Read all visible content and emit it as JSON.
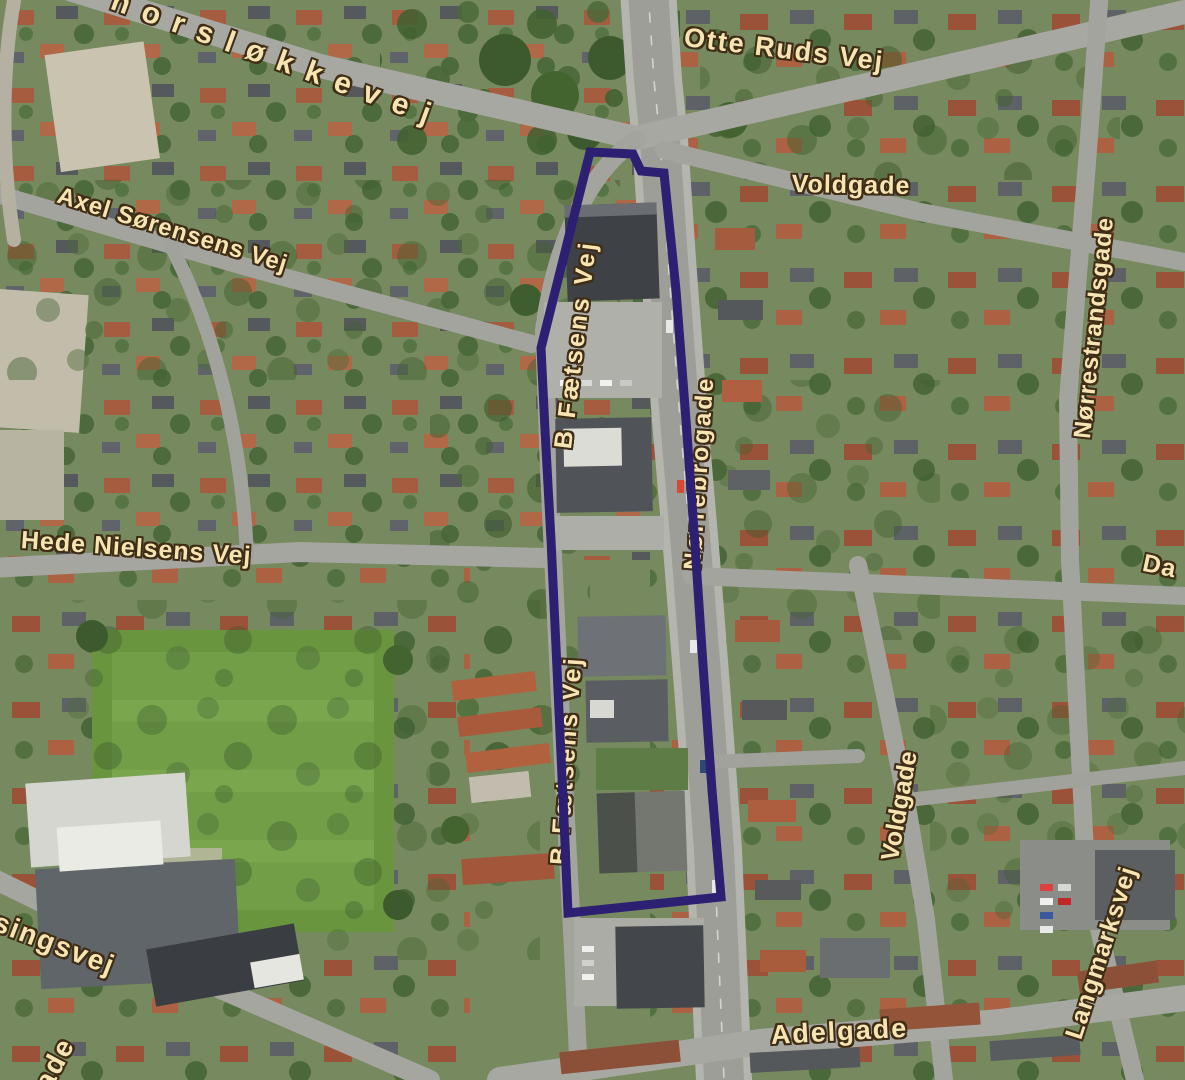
{
  "map": {
    "type": "aerial-orthophoto",
    "description": "Aerial photo map of a Danish town district with a highlighted selection polygon along Nørrebrogade",
    "street_labels": [
      {
        "name": "horslokkevej",
        "text": "horsløkkevej"
      },
      {
        "name": "otte-ruds-vej",
        "text": "Otte Ruds Vej"
      },
      {
        "name": "axel-sorensens-vej",
        "text": "Axel Sørensens Vej"
      },
      {
        "name": "voldgade-north",
        "text": "Voldgade"
      },
      {
        "name": "norrestrandsgade",
        "text": "Nørrestrandsgade"
      },
      {
        "name": "b-faetsens-vej",
        "text": "B Fætsens Vej"
      },
      {
        "name": "norrebrogade",
        "text": "Nørrebrogade"
      },
      {
        "name": "hede-nielsens-vej",
        "text": "Hede Nielsens Vej"
      },
      {
        "name": "da-partial",
        "text": "Da"
      },
      {
        "name": "b-faetsens-vej-south",
        "text": "B Fætsens Vej"
      },
      {
        "name": "voldgade-south",
        "text": "Voldgade"
      },
      {
        "name": "langmarksvej",
        "text": "Langmarksvej"
      },
      {
        "name": "fussingsvej-partial",
        "text": "ssingsvej"
      },
      {
        "name": "gade-partial",
        "text": "ade"
      },
      {
        "name": "adelgade",
        "text": "Adelgade"
      }
    ],
    "overlay": {
      "stroke_color": "#2d2072",
      "stroke_width": 9,
      "polygon": [
        [
          590,
          152
        ],
        [
          633,
          154
        ],
        [
          641,
          171
        ],
        [
          664,
          173
        ],
        [
          676,
          290
        ],
        [
          686,
          420
        ],
        [
          695,
          545
        ],
        [
          703,
          665
        ],
        [
          712,
          790
        ],
        [
          721,
          897
        ],
        [
          568,
          913
        ],
        [
          564,
          820
        ],
        [
          558,
          690
        ],
        [
          551,
          540
        ],
        [
          545,
          430
        ],
        [
          541,
          348
        ]
      ]
    }
  }
}
